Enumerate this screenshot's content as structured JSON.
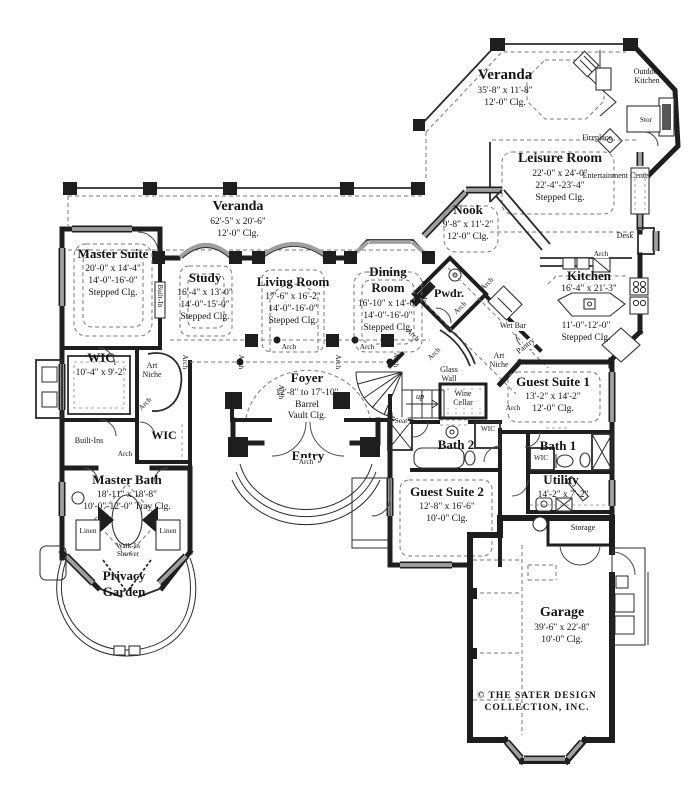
{
  "colors": {
    "wall": "#1e1e1e",
    "window": "#a0a0a0",
    "dashed": "#787878",
    "paper": "#ffffff"
  },
  "rooms": {
    "veranda_rear": {
      "name": "Veranda",
      "dims": [
        "35'-8\" x  11'-8\"",
        "12'-0\" Clg."
      ]
    },
    "leisure": {
      "name": "Leisure Room",
      "dims": [
        "22'-0\" x 24'-0\"",
        "22'-4\"-23'-4\"",
        "Stepped Clg."
      ]
    },
    "nook": {
      "name": "Nook",
      "dims": [
        "9'-8\" x 11'-2\"",
        "12'-0\" Clg."
      ]
    },
    "kitchen": {
      "name": "Kitchen",
      "dims": [
        "16'-4\" x 21'-3\"",
        "11'-0\"-12'-0\"",
        "Stepped Clg."
      ]
    },
    "veranda_main": {
      "name": "Veranda",
      "dims": [
        "62'-5\" x 20'-6\"",
        "12'-0\" Clg."
      ]
    },
    "master_suite": {
      "name": "Master Suite",
      "dims": [
        "20'-0\" x 14'-4\"",
        "14'-0\"-16'-0\"",
        "Stepped Clg."
      ]
    },
    "study": {
      "name": "Study",
      "dims": [
        "16'-4\" x 13'-0\"",
        "14'-0\"-15'-0\"",
        "Stepped Clg."
      ]
    },
    "living_room": {
      "name": "Living Room",
      "dims": [
        "17'-6\" x 16'-2\"",
        "14'-0\"-16'-0\"",
        "Stepped Clg."
      ]
    },
    "dining_room": {
      "name": "Dining Room",
      "dims": [
        "16'-10\" x 14'-0\"",
        "14'-0\"-16'-0\"",
        "Stepped Clg."
      ]
    },
    "pwdr": {
      "name": "Pwdr."
    },
    "foyer": {
      "name": "Foyer",
      "dims": [
        "12'-8\" to 17'-10\"",
        "Barrel",
        "Vault Clg."
      ]
    },
    "entry": {
      "name": "Entry"
    },
    "wic_master": {
      "name": "WIC",
      "dims": [
        "10'-4\" x 9'-2\""
      ]
    },
    "wic2": {
      "name": "WIC"
    },
    "master_bath": {
      "name": "Master Bath",
      "dims": [
        "18'-11\" x 18'-8\"",
        "10'-0\"-12'-0\" Tray Clg."
      ]
    },
    "privacy_garden": {
      "name": "Privacy Garden"
    },
    "guest_suite_1": {
      "name": "Guest Suite 1",
      "dims": [
        "13'-2\" x 14'-2\"",
        "12'-0\" Clg."
      ]
    },
    "bath1": {
      "name": "Bath 1"
    },
    "utility": {
      "name": "Utility",
      "dims": [
        "14'-2\" x 7'-2\""
      ]
    },
    "guest_suite_2": {
      "name": "Guest Suite 2",
      "dims": [
        "12'-8\" x 16'-6\"",
        "10'-0\" Clg."
      ]
    },
    "bath2": {
      "name": "Bath 2"
    },
    "garage": {
      "name": "Garage",
      "dims": [
        "39'-6\" x 22'-8\"",
        "10'-0\" Clg."
      ]
    },
    "wine_cellar": {
      "name": "Wine Cellar"
    },
    "storage": {
      "name": "Storage"
    }
  },
  "features": {
    "arch": "Arch",
    "art_niche": "Art Niche",
    "built_in": "Built-In",
    "built_ins": "Built-Ins",
    "wic": "WIC",
    "linen": "Linen",
    "walk_in_shower": "Walk-In Shower",
    "seat": "Seat",
    "glass_wall": "Glass Wall",
    "wet_bar": "Wet Bar",
    "pantry": "Pantry",
    "desk": "Desk",
    "stor": "Stor",
    "fireplace": "Fireplace",
    "entertainment_center": "Entertainment Center",
    "outdoor_kitchen": "Outdoor Kitchen",
    "up": "up"
  },
  "copyright": {
    "line1": "© THE SATER DESIGN",
    "line2": "COLLECTION, INC."
  }
}
